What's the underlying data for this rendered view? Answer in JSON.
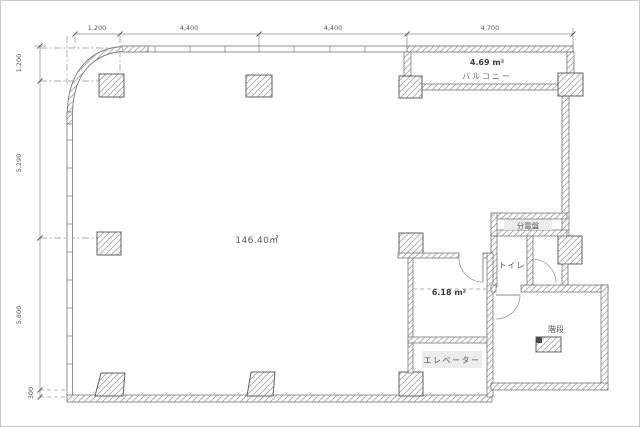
{
  "plan": {
    "labels": {
      "main_area": "146.40㎡",
      "balcony_area": "4.69 m²",
      "balcony": "バルコニー",
      "distribution_board": "分電盤",
      "toilet": "トイレ",
      "service_area": "6.18 m²",
      "stairs": "階段",
      "elevator": "エレベーター"
    },
    "dimensions_top": [
      "1,200",
      "4,400",
      "4,400",
      "4,700"
    ],
    "dimensions_left": [
      "1,200",
      "5,290",
      "5,800",
      "300"
    ],
    "colors": {
      "wall_line": "#787878",
      "hatch_line": "#a8a8a8",
      "dimension_text": "#5a5a5a",
      "label_text": "#3d3d3d",
      "label_background": "#ececec"
    }
  }
}
